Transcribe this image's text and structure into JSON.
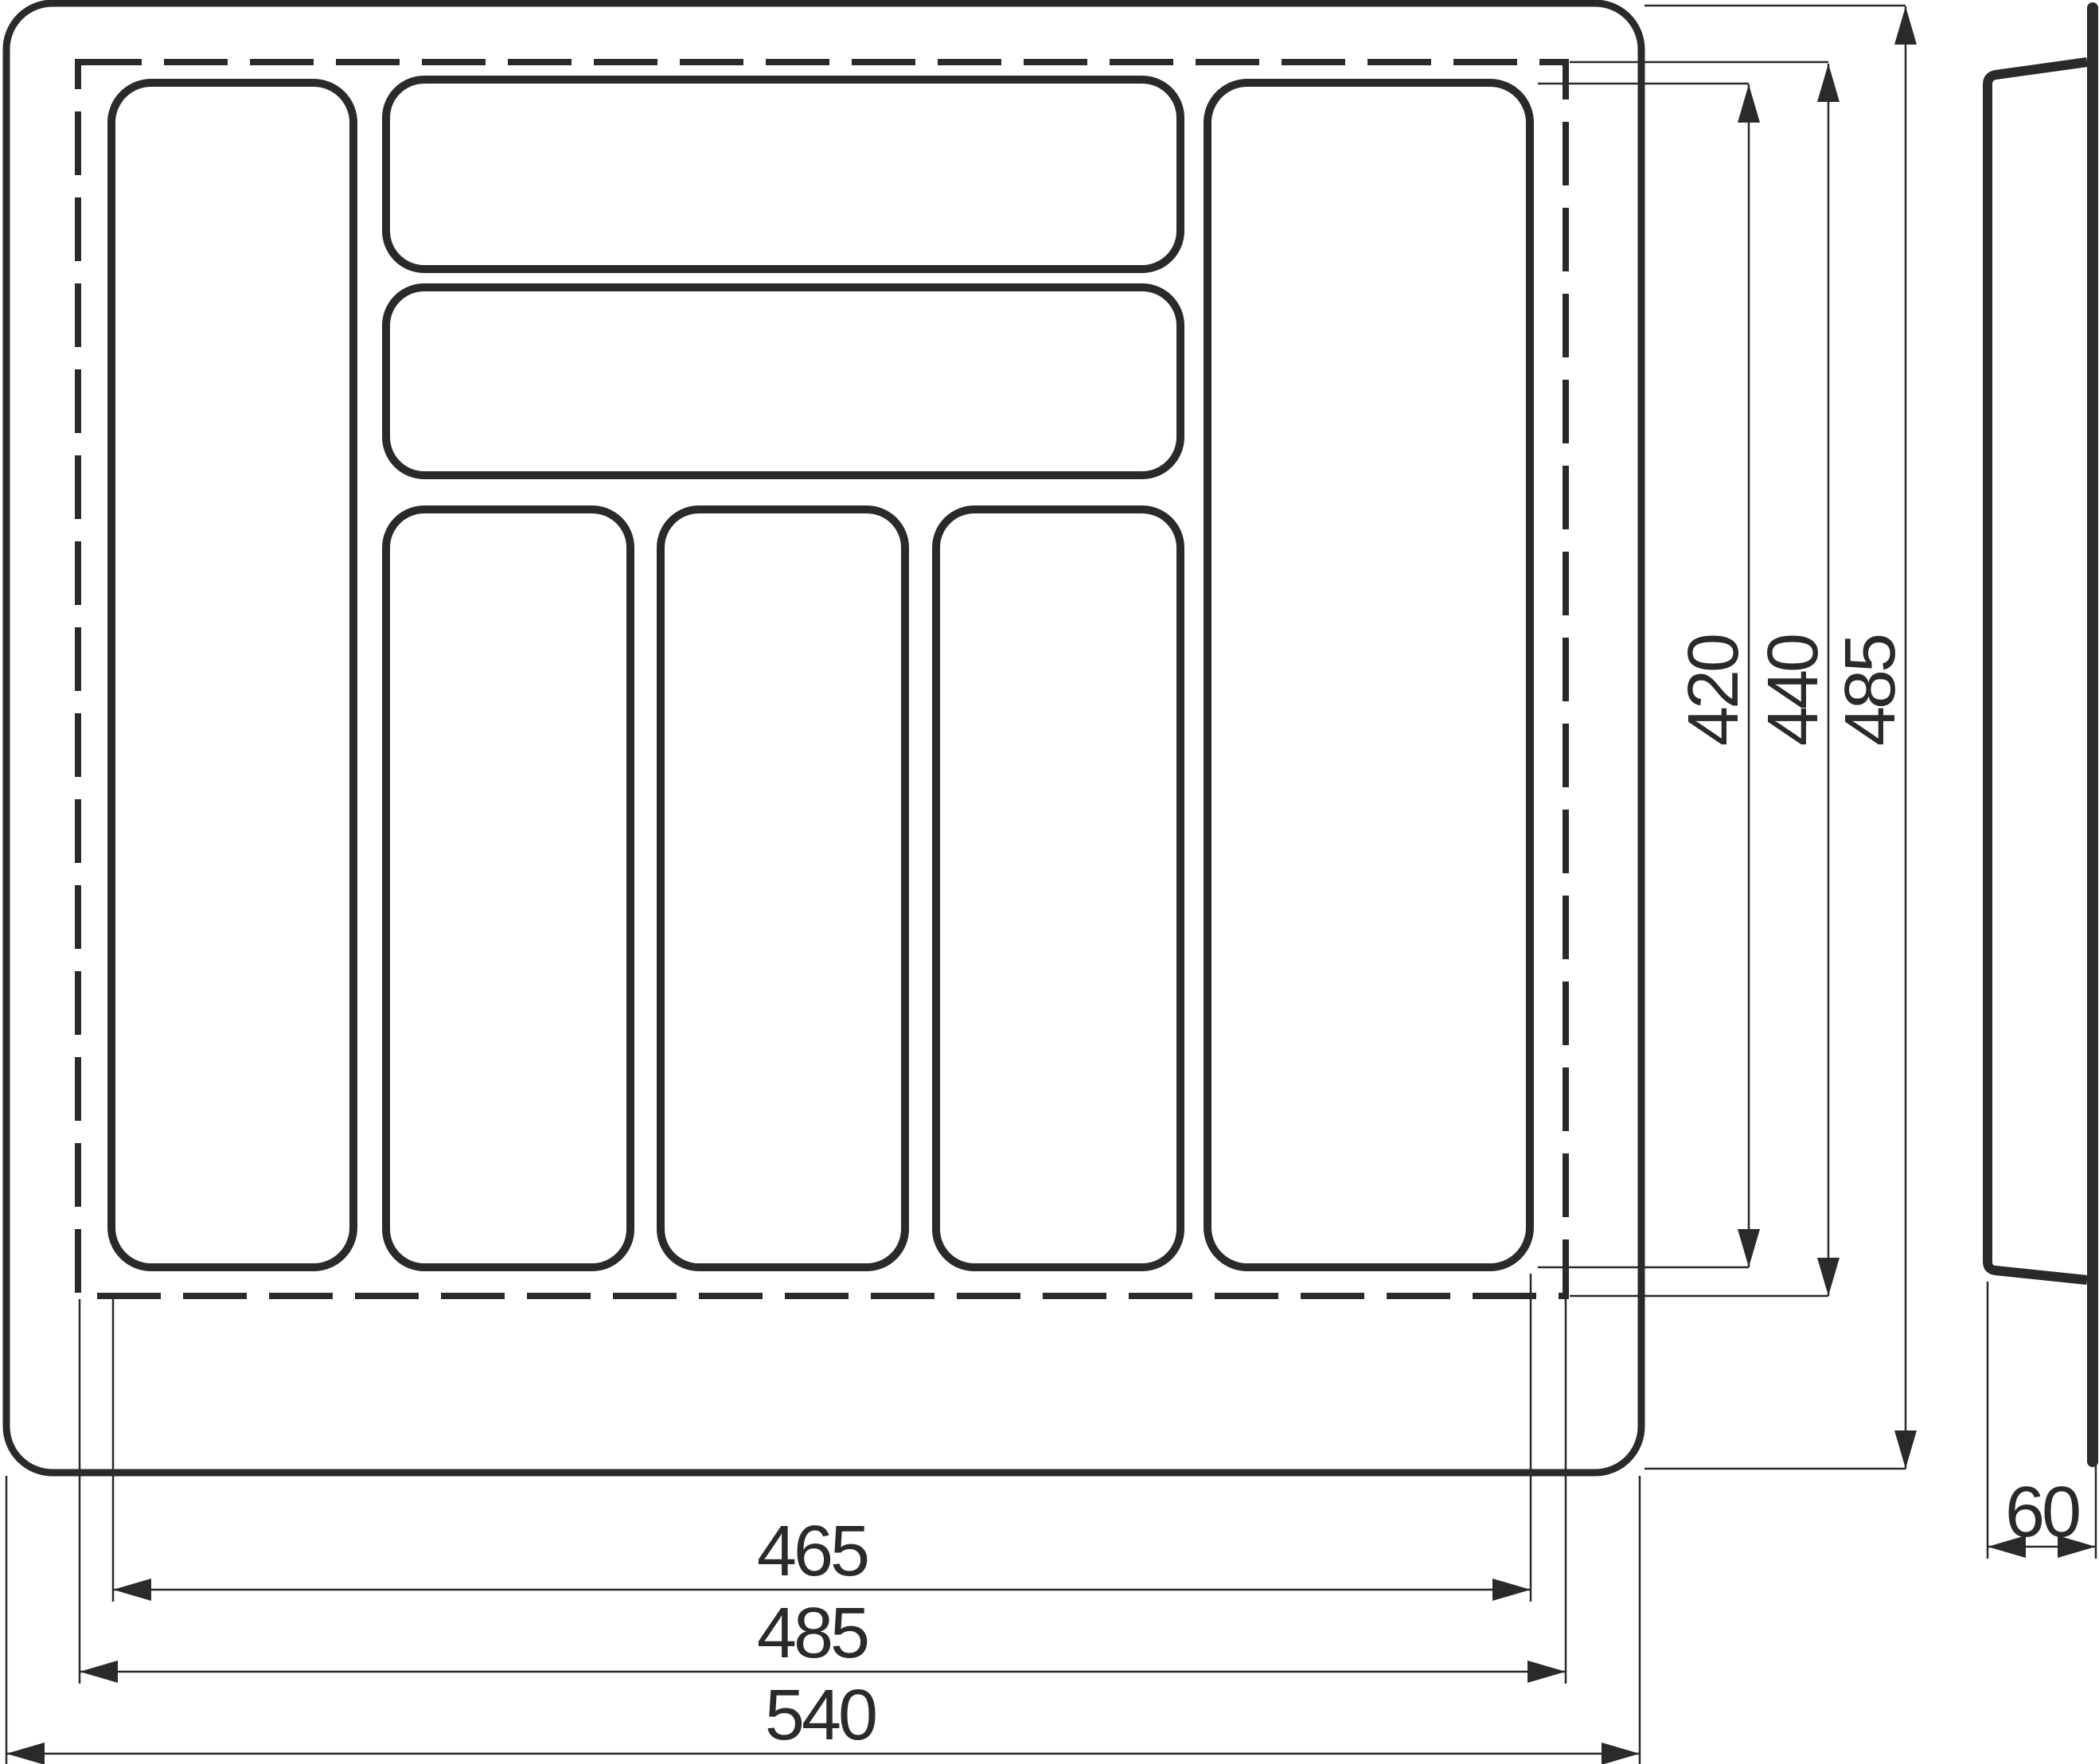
{
  "drawing": {
    "type": "technical-drawing",
    "subject": "cutlery-tray-drawer-insert",
    "units": "mm",
    "views": {
      "plan": {
        "description": "top view of cutlery tray with 7 compartments, dashed trim line",
        "compartment_count": 7,
        "dims": {
          "inner_width": "465",
          "trim_width": "485",
          "outer_width": "540",
          "inner_height": "420",
          "trim_height": "440",
          "outer_height": "485"
        }
      },
      "side": {
        "description": "side profile of tray",
        "dims": {
          "thickness": "60"
        }
      }
    },
    "colors": {
      "line": "#2b2a29",
      "background": "#ffffff"
    }
  }
}
